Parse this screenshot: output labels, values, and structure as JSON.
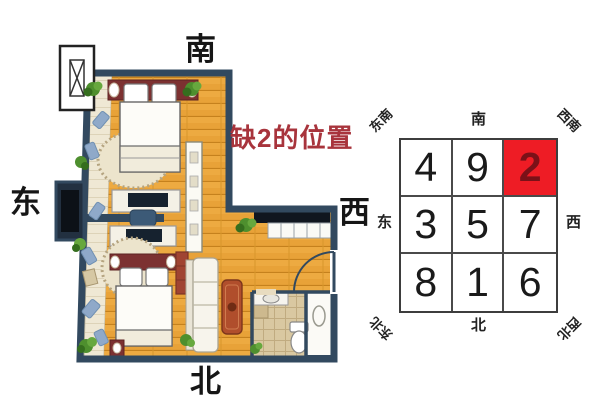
{
  "annotation": {
    "label": "缺2的位置",
    "color": "#a8343c"
  },
  "floor_plan": {
    "direction_labels": {
      "south": "南",
      "east": "东",
      "west": "西",
      "north": "北"
    },
    "colors": {
      "wall": "#32495f",
      "wood_floor": "#e8a238",
      "balcony_floor": "#efe8d4",
      "bathroom_tile": "#d9c8a1",
      "furniture_red": "#7c3131",
      "plant_green": "#4e8f2e"
    }
  },
  "luoshu": {
    "rows": [
      [
        "4",
        "9",
        "2"
      ],
      [
        "3",
        "5",
        "7"
      ],
      [
        "8",
        "1",
        "6"
      ]
    ],
    "highlight": {
      "value": "2",
      "row": 0,
      "col": 2,
      "cell_color": "#ee1c25",
      "number_color": "#7a1118"
    },
    "direction_labels": {
      "south": "南",
      "north": "北",
      "east": "东",
      "west": "西",
      "southeast": "东南",
      "southwest": "西南",
      "northeast": "东北",
      "northwest": "西北"
    }
  }
}
